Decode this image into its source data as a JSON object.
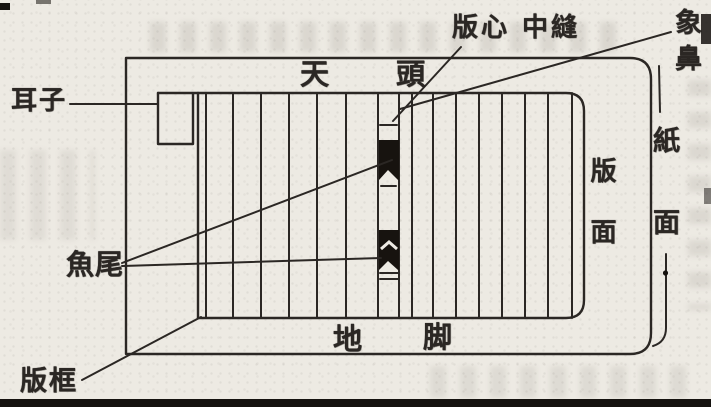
{
  "colors": {
    "ink": "#2b2724",
    "paper": "#edeae3",
    "mark": "#17130f"
  },
  "figure": {
    "description": "Layout diagram of a traditional Chinese block-printed book page"
  },
  "labels": {
    "ear": "耳子",
    "fish_tail": "魚尾",
    "frame": "版框",
    "center_strip": "版心 中縫",
    "elephant_nose": "象鼻",
    "paper_surface": "紙面",
    "block_surface": "版面",
    "top_margin": {
      "first": "天",
      "second": "頭"
    },
    "bottom_margin": {
      "first": "地",
      "second": "脚"
    }
  }
}
